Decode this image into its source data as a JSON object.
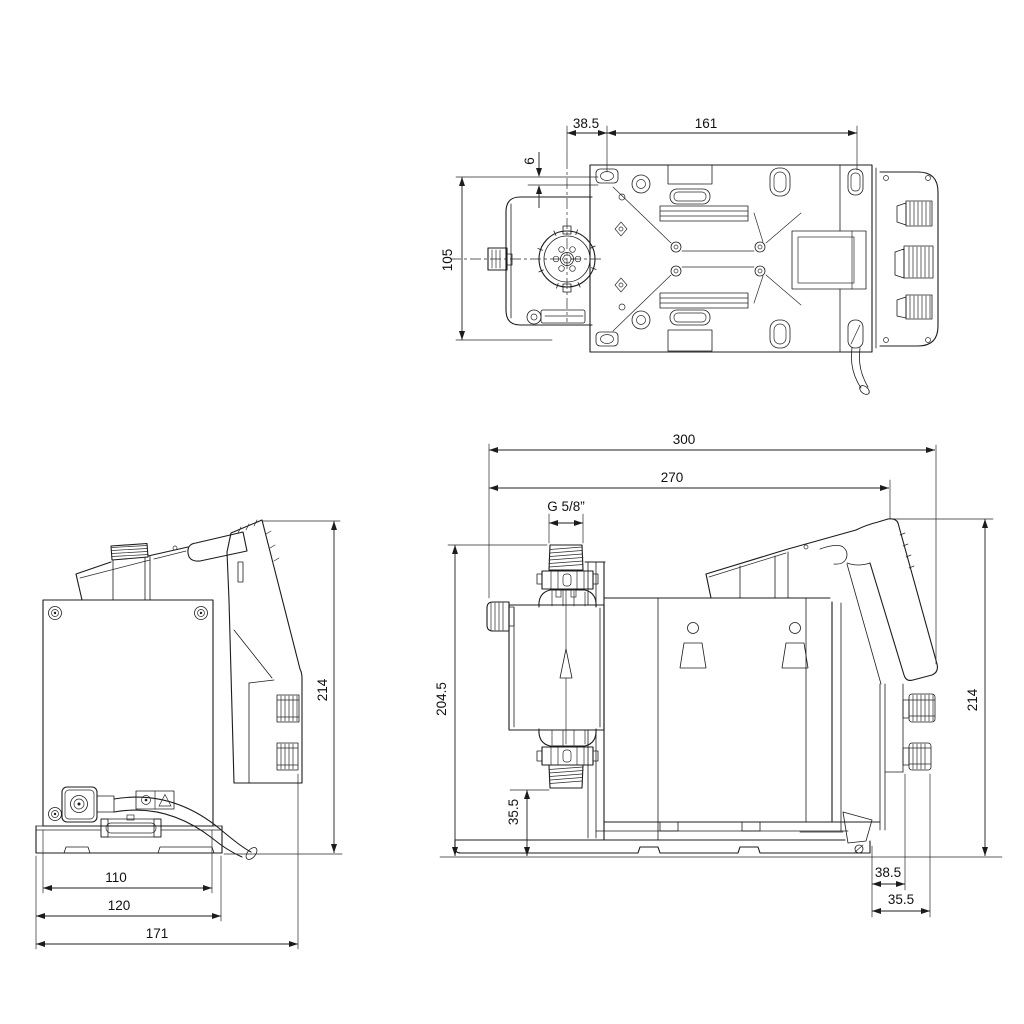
{
  "drawing": {
    "background": "#ffffff",
    "line_color": "#1c1c1c",
    "text_color": "#111111",
    "views": {
      "top": {
        "dims": {
          "d38_5": "38.5",
          "d161": "161",
          "d6": "6",
          "d105": "105"
        }
      },
      "rear": {
        "dims": {
          "d214": "214",
          "d110": "110",
          "d120": "120",
          "d171": "171"
        }
      },
      "side": {
        "dims": {
          "d300": "300",
          "d270": "270",
          "thread": "G 5/8”",
          "d204_5": "204.5",
          "d35_5_head": "35.5",
          "d214": "214",
          "d38_5_base": "38.5",
          "d35_5_base": "35.5"
        }
      }
    }
  }
}
